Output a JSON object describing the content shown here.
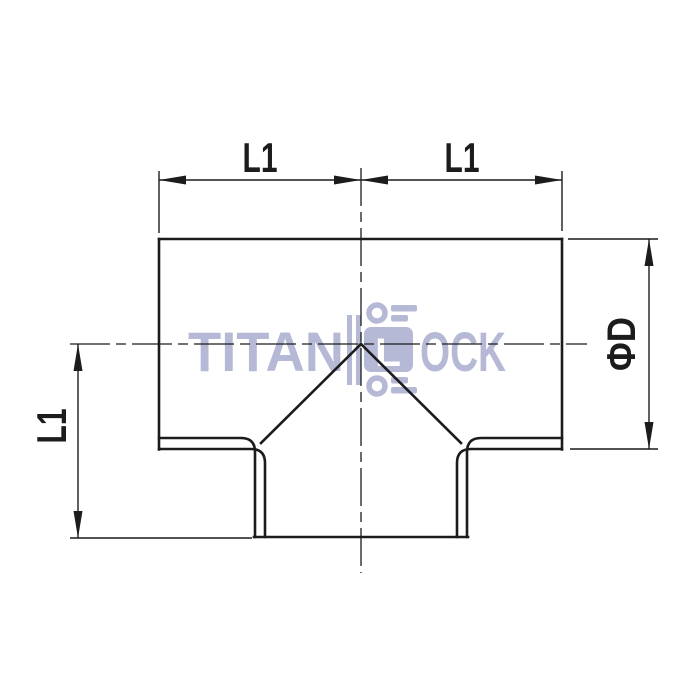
{
  "drawing": {
    "description": "Tee pipe fitting front view technical drawing",
    "background": "#ffffff",
    "line_color": "#1c1c1c",
    "dimension_labels": {
      "top_left": "L1",
      "top_right": "L1",
      "left_vertical": "L1",
      "right_diameter": "ΦD"
    },
    "watermark": {
      "brand_prefix": "TITAN",
      "brand_suffix": "OCK",
      "lock_letter": "L",
      "color": "#b5b9d6",
      "icon": "padlock-icon"
    }
  }
}
